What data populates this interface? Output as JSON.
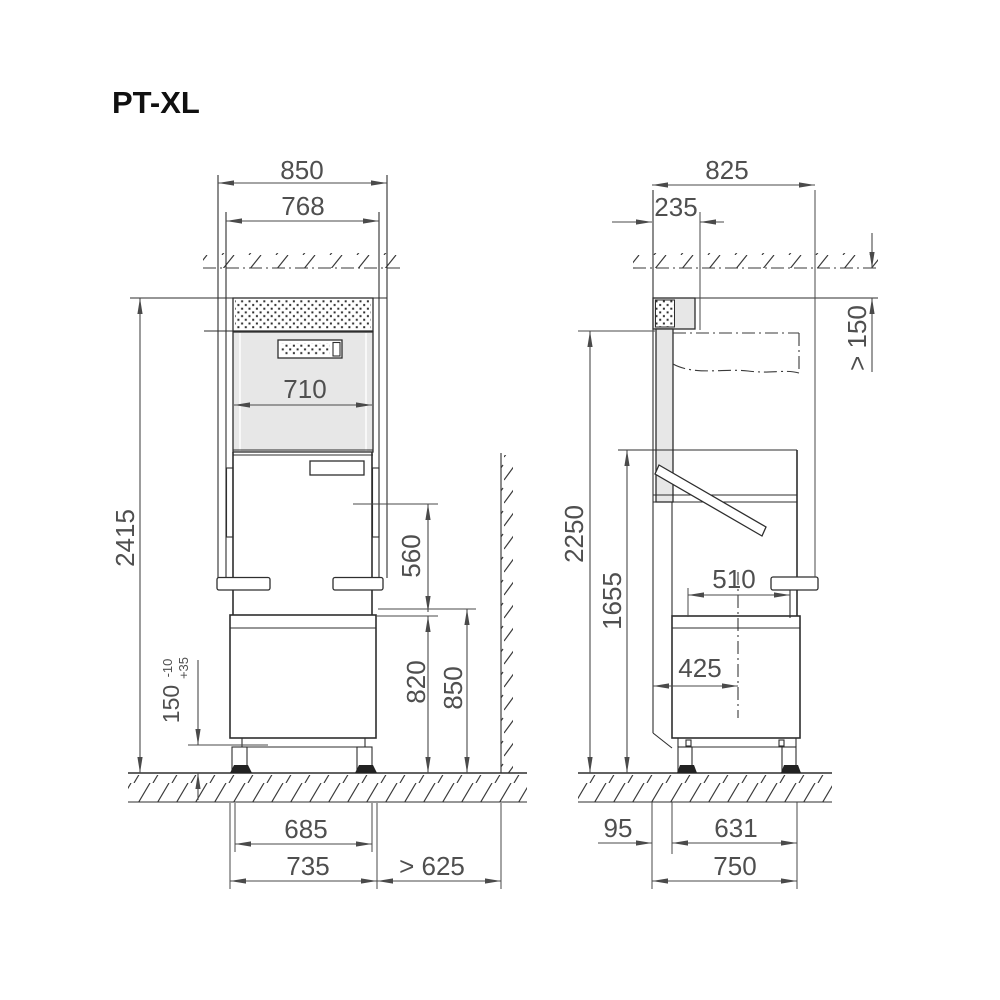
{
  "title": "PT-XL",
  "views": {
    "front": {
      "dims": {
        "width_total": "850",
        "width_inner": "768",
        "width_opening": "710",
        "height_total": "2415",
        "pass_height": "560",
        "base_height": "820",
        "table_height": "850",
        "feet_height": "150",
        "feet_tol_plus": "+35",
        "feet_tol_minus": "-10",
        "feet_span": "685",
        "base_width": "735",
        "side_clearance": "> 625"
      }
    },
    "side": {
      "dims": {
        "depth_total": "825",
        "duct_depth": "235",
        "top_clearance": "> 150",
        "open_height": "2250",
        "hood_height": "1655",
        "rack_depth": "510",
        "rack_center": "425",
        "front_offset": "95",
        "feet_depth": "631",
        "base_depth": "750"
      }
    }
  },
  "colors": {
    "line": "#2e2e2e",
    "dimension": "#4a4a4a",
    "panel_gray": "#e7e7e7"
  }
}
